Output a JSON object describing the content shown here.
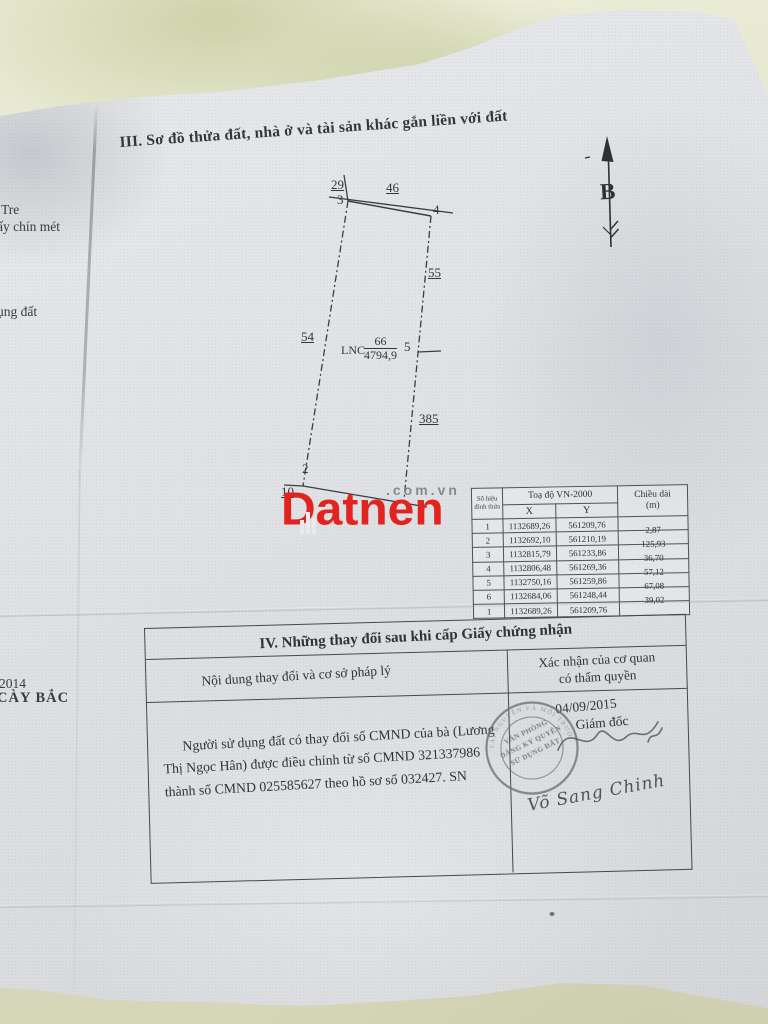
{
  "document": {
    "section3_title": "III. Sơ đồ thửa đất, nhà ở và tài sản khác gắn liền với đất",
    "north_label": "B"
  },
  "diagram": {
    "parcel_code": "LNC",
    "parcel_number": "66",
    "parcel_area": "4794,9",
    "vertices": {
      "v2": "2",
      "v3": "3",
      "v4": "4",
      "v5": "5"
    },
    "neighbors": {
      "top_left": "29",
      "top": "46",
      "right_upper": "55",
      "left": "54",
      "right_lower": "385",
      "bottom_left": "10"
    }
  },
  "coord_table": {
    "vertex_col_line1": "Số hiệu",
    "vertex_col_line2": "đỉnh thửa",
    "coord_header": "Toạ độ VN-2000",
    "x_label": "X",
    "y_label": "Y",
    "length_line1": "Chiều dài",
    "length_line2": "(m)",
    "rows": [
      {
        "id": "1",
        "x": "1132689,26",
        "y": "561209,76",
        "len": "2,87"
      },
      {
        "id": "2",
        "x": "1132692,10",
        "y": "561210,19",
        "len": "125,93"
      },
      {
        "id": "3",
        "x": "1132815,79",
        "y": "561233,86",
        "len": "36,70"
      },
      {
        "id": "4",
        "x": "1132806,48",
        "y": "561269,36",
        "len": "57,12"
      },
      {
        "id": "5",
        "x": "1132750,16",
        "y": "561259,86",
        "len": "67,08"
      },
      {
        "id": "6",
        "x": "1132684,06",
        "y": "561248,44",
        "len": "39,02"
      },
      {
        "id": "1",
        "x": "1132689,26",
        "y": "561209,76",
        "len": ""
      }
    ]
  },
  "section4": {
    "title": "IV. Những thay đổi sau khi cấp Giấy chứng nhận",
    "col1_header": "Nội dung thay đổi và cơ sở pháp lý",
    "col2_header_line1": "Xác nhận của cơ quan",
    "col2_header_line2": "có thẩm quyền",
    "content": "Người sử dụng đất có thay đổi số CMND của bà (Lương Thị Ngọc Hân) được điều chỉnh từ số CMND 321337986 thành số CMND 025585627 theo hồ sơ số 032427. SN",
    "date": "04/09/2015",
    "approver_title": "Giám đốc",
    "signer_name": "Võ Sang Chinh",
    "stamp_line1": "VĂN PHÒNG",
    "stamp_line2": "ĐĂNG KÝ QUYỀN",
    "stamp_line3": "SỬ DỤNG ĐẤT",
    "stamp_ring": "TÀI NGUYÊN VÀ MÔI TRƯỜNG"
  },
  "watermark": {
    "brand": "Datnen",
    "domain_suffix": ".com.vn",
    "brand_color": "#e1241f"
  },
  "edge_fragments": {
    "f1": "Tre",
    "f2": "ấy chín mét",
    "f3": "ụng đất",
    "f4": "2014",
    "f5": "CÀY BẮC"
  }
}
